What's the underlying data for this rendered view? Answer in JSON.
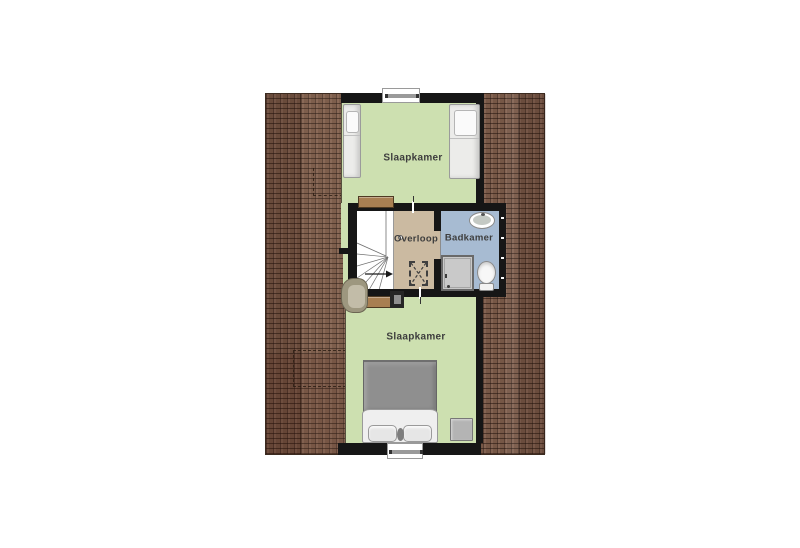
{
  "floorplan": {
    "type": "attic-floor-plan",
    "rooms": {
      "bedroom_top": {
        "label": "Slaapkamer"
      },
      "landing": {
        "label": "Overloop"
      },
      "bathroom": {
        "label": "Badkamer"
      },
      "bedroom_bottom": {
        "label": "Slaapkamer"
      }
    },
    "palette": {
      "floor_bedroom": "#cde0b0",
      "floor_landing": "#cbbaa1",
      "floor_bathroom": "#a7bbd2",
      "roof_tile": "#7d5c4a",
      "roof_grout": "#21120c",
      "wall": "#161616",
      "background": "#ffffff"
    },
    "fixtures": [
      "single-bed",
      "single-bed-wide",
      "double-bed",
      "pillows",
      "armchair",
      "desk",
      "bench",
      "winder-stairs",
      "stair-direction-arrow",
      "loft-hatch",
      "wash-basin",
      "toilet",
      "shower",
      "chimney-duct",
      "window-top",
      "window-bottom",
      "roof-annotation-dashes"
    ]
  }
}
